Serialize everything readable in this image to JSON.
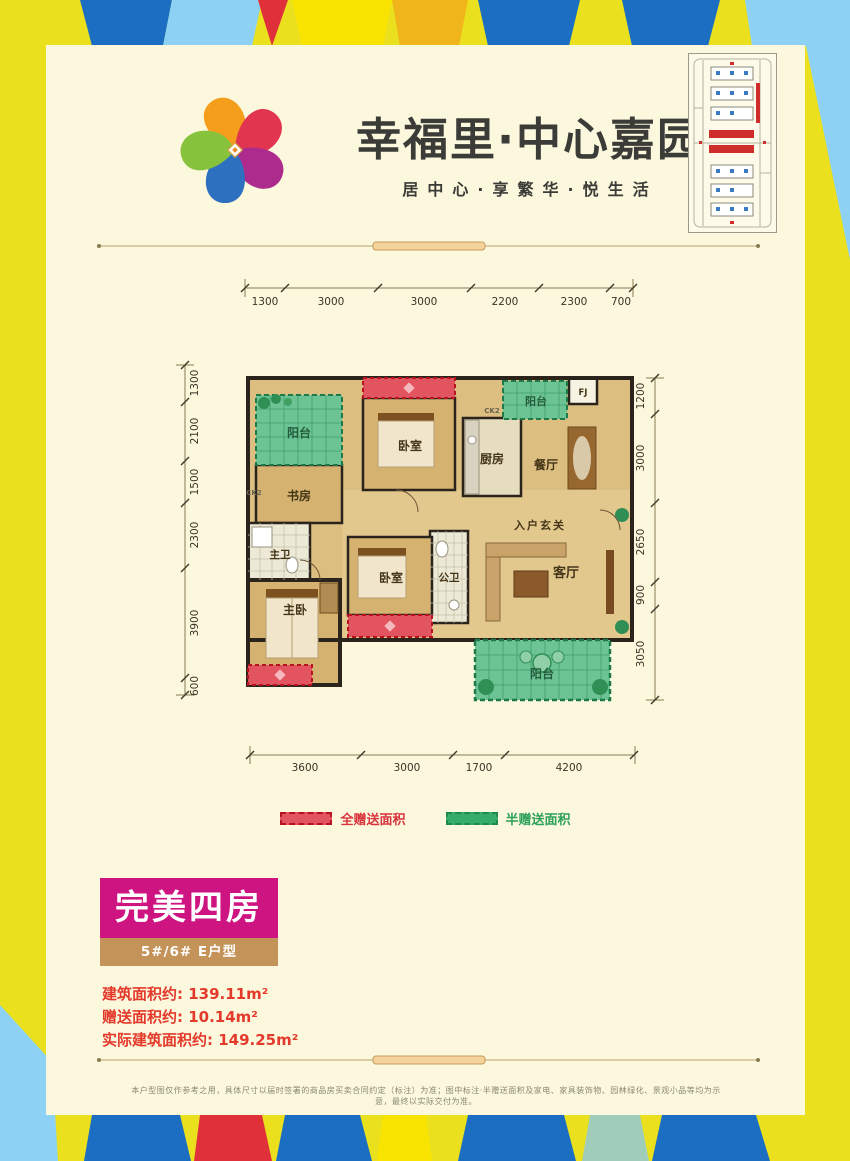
{
  "header": {
    "title": "幸福里·中心嘉园",
    "subtitle": "居中心·享繁华·悦生活"
  },
  "floorplan": {
    "dims": {
      "top": [
        "1300",
        "3000",
        "3000",
        "2200",
        "2300",
        "700"
      ],
      "left": [
        "1300",
        "2100",
        "1500",
        "2300",
        "3900",
        "600"
      ],
      "right": [
        "1200",
        "3000",
        "2650",
        "900",
        "3050"
      ],
      "bottom": [
        "3600",
        "3000",
        "1700",
        "4200"
      ]
    },
    "rooms": {
      "balcony_tl": "阳台",
      "study": "书房",
      "master_bath": "主卫",
      "master_bed": "主卧",
      "bedroom_top": "卧室",
      "bedroom_mid": "卧室",
      "kitchen": "厨房",
      "dining": "餐厅",
      "balcony_tr": "阳台",
      "shaft": "FJ",
      "entry": "入户玄关",
      "guest_bath": "公卫",
      "living": "客厅",
      "balcony_bottom": "阳台"
    },
    "window_code": "CK2"
  },
  "legend": {
    "full": {
      "label": "全赠送面积",
      "color": "#D8333C"
    },
    "half": {
      "label": "半赠送面积",
      "color": "#2CA05A"
    }
  },
  "info": {
    "headline": "完美四房",
    "headline_bg": "#CE1480",
    "unit": "5#/6#  E户型",
    "unit_bg": "#C49359",
    "stats": [
      "建筑面积约: 139.11m²",
      "赠送面积约: 10.14m²",
      "实际建筑面积约: 149.25m²"
    ],
    "stats_color": "#E43A2C"
  },
  "disclaimer": "本户型图仅作参考之用，具体尺寸以届时签署的商品房买卖合同约定（标注）为准；图中标注·半赠送面积及家电、家具装饰物、园林绿化、景观小品等均为示意，最终以实际交付为准。"
}
